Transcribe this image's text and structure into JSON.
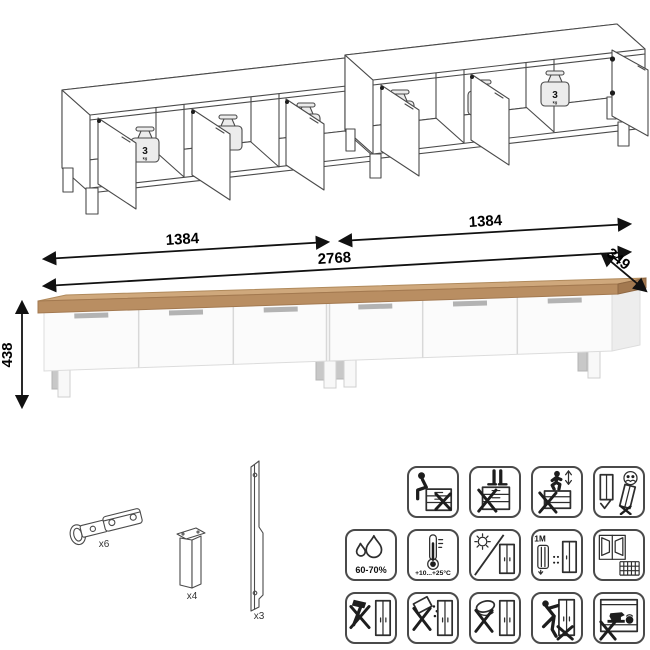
{
  "colors": {
    "line_art": "#4a4a4a",
    "dimension": "#111111",
    "wood_front": "#b98e62",
    "wood_top": "#cfa87c",
    "wood_end": "#a37950",
    "body_white": "#fbfbfb",
    "body_side": "#ededed",
    "door_divider": "#d8d8d8",
    "handle_gray": "#b3b3b3",
    "icon_border": "#4a4a4a"
  },
  "isometric": {
    "weight_value": "3",
    "weight_unit": "kg"
  },
  "dimensions": {
    "left_width": "1384",
    "right_width": "1384",
    "total_width": "2768",
    "depth": "349",
    "height": "438"
  },
  "hardware": {
    "hinge_count": "x6",
    "leg_count": "x4",
    "strip_count": "x3"
  },
  "care_icons": {
    "humidity_label": "60-70%",
    "temperature_label": "+10...+25°C",
    "distance_label": "≥1M",
    "row1": [
      "no-sitting",
      "no-standing",
      "no-jumping",
      "carry-with-two-people"
    ],
    "row2": [
      "humidity-range",
      "temperature-range",
      "avoid-direct-sunlight",
      "min-1m-from-heat",
      "ventilated-room"
    ],
    "row3": [
      "no-impact-tools",
      "no-spilling-liquids",
      "no-abrasive-cleaners",
      "no-dragging",
      "no-overloading"
    ]
  }
}
